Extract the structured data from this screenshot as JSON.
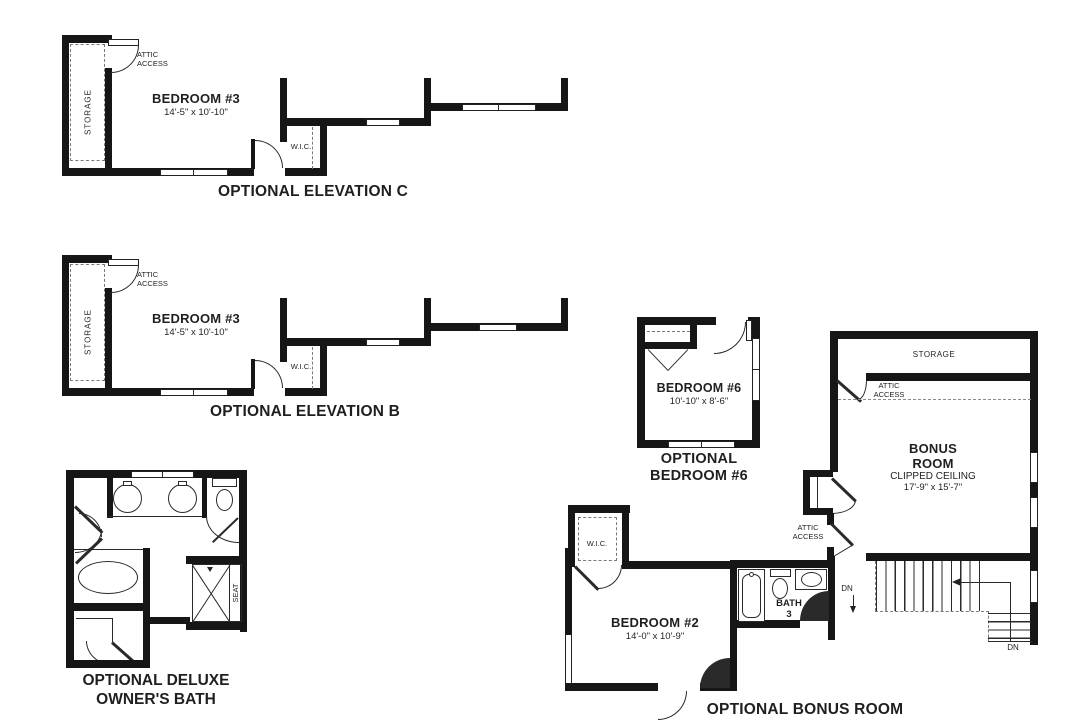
{
  "elevation_c": {
    "caption": "OPTIONAL ELEVATION C",
    "room": "BEDROOM #3",
    "dims": "14'-5\" x 10'-10\"",
    "storage": "STORAGE",
    "attic_line1": "ATTIC",
    "attic_line2": "ACCESS",
    "wic": "W.I.C."
  },
  "elevation_b": {
    "caption": "OPTIONAL ELEVATION B",
    "room": "BEDROOM #3",
    "dims": "14'-5\" x 10'-10\"",
    "storage": "STORAGE",
    "attic_line1": "ATTIC",
    "attic_line2": "ACCESS",
    "wic": "W.I.C."
  },
  "owners_bath": {
    "caption_line1": "OPTIONAL DELUXE",
    "caption_line2": "OWNER'S BATH",
    "seat": "SEAT"
  },
  "bedroom6": {
    "caption_line1": "OPTIONAL",
    "caption_line2": "BEDROOM #6",
    "room": "BEDROOM #6",
    "dims": "10'-10\" x 8'-6\""
  },
  "bonus_room": {
    "caption": "OPTIONAL BONUS ROOM",
    "room_line1": "BONUS",
    "room_line2": "ROOM",
    "ceiling": "CLIPPED CEILING",
    "dims": "17'-9\" x 15'-7\"",
    "storage": "STORAGE",
    "attic_line1": "ATTIC",
    "attic_line2": "ACCESS",
    "attic2_line1": "ATTIC",
    "attic2_line2": "ACCESS",
    "dn_left": "DN",
    "dn_right": "DN"
  },
  "bedroom2": {
    "room": "BEDROOM #2",
    "dims": "14'-0\" x 10'-9\"",
    "wic": "W.I.C.",
    "bath_line1": "BATH",
    "bath_line2": "3"
  }
}
